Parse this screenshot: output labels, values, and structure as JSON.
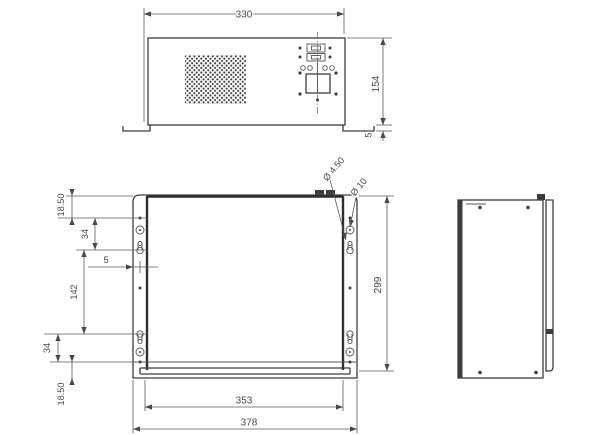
{
  "drawing": {
    "background": "#ffffff",
    "ink_color": "#3d3d3d",
    "dim_color": "#4a4a4a",
    "views": {
      "front": {
        "dims": {
          "width": "330",
          "height": "154",
          "foot_height": "5"
        }
      },
      "rear": {
        "dims": {
          "top_offset": "18.50",
          "upper_hole_spacing": "34",
          "hole_span": "142",
          "lower_hole_spacing": "34",
          "bottom_offset": "18.50",
          "flange_width": "5",
          "height": "299",
          "inner_width": "353",
          "overall_width": "378"
        },
        "callouts": {
          "slot_diameter": "Ø 4.50",
          "hole_diameter": "Ø 10"
        }
      },
      "side": {}
    }
  }
}
